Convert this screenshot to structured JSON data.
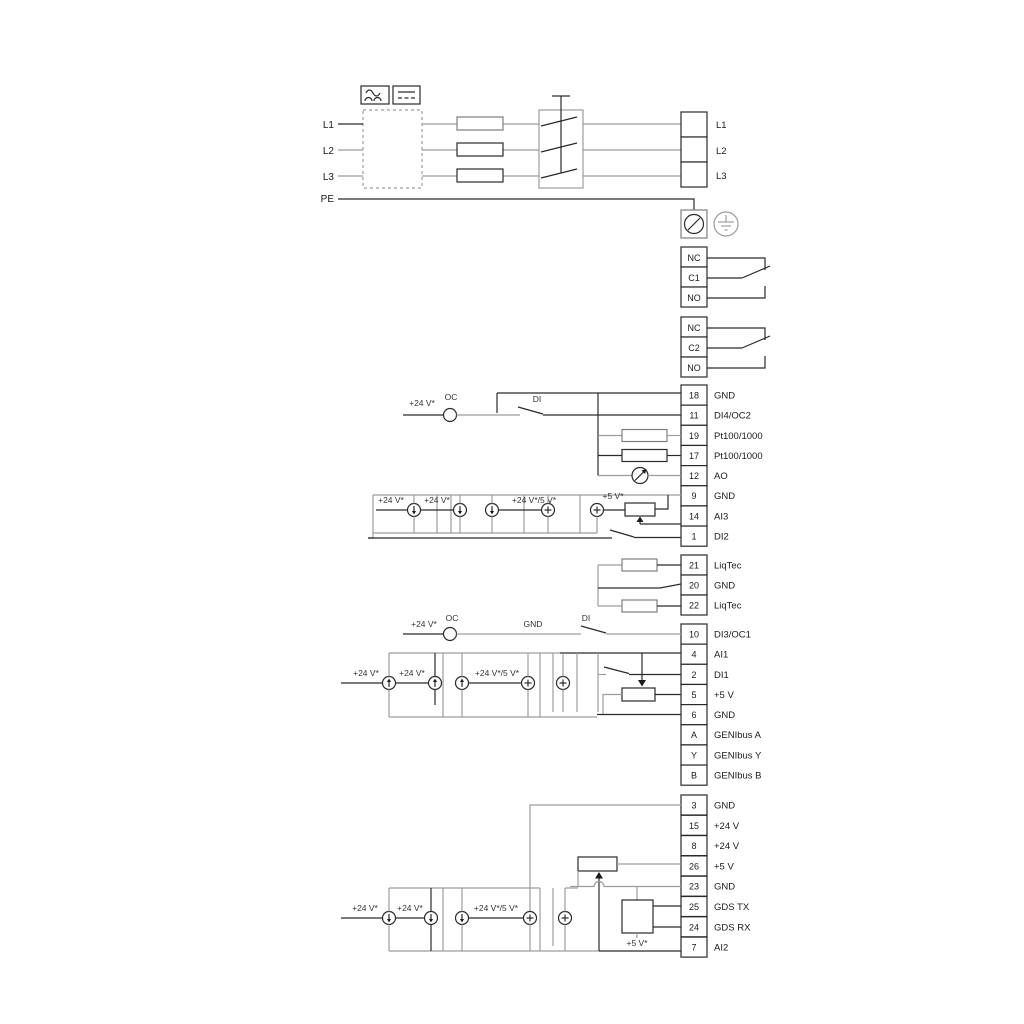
{
  "power": {
    "inputs": [
      "L1",
      "L2",
      "L3",
      "PE"
    ],
    "outputs": [
      "L1",
      "L2",
      "L3"
    ]
  },
  "relay1": {
    "t1": "NC",
    "t2": "C1",
    "t3": "NO"
  },
  "relay2": {
    "t1": "NC",
    "t2": "C2",
    "t3": "NO"
  },
  "io1": {
    "terminals": [
      {
        "n": "18",
        "l": "GND"
      },
      {
        "n": "11",
        "l": "DI4/OC2"
      },
      {
        "n": "19",
        "l": "Pt100/1000"
      },
      {
        "n": "17",
        "l": "Pt100/1000"
      },
      {
        "n": "12",
        "l": "AO"
      },
      {
        "n": "9",
        "l": "GND"
      },
      {
        "n": "14",
        "l": "AI3"
      },
      {
        "n": "1",
        "l": "DI2"
      }
    ]
  },
  "liqtec": {
    "terminals": [
      {
        "n": "21",
        "l": "LiqTec"
      },
      {
        "n": "20",
        "l": "GND"
      },
      {
        "n": "22",
        "l": "LiqTec"
      }
    ]
  },
  "io2": {
    "terminals": [
      {
        "n": "10",
        "l": "DI3/OC1"
      },
      {
        "n": "4",
        "l": "AI1"
      },
      {
        "n": "2",
        "l": "DI1"
      },
      {
        "n": "5",
        "l": "+5 V"
      },
      {
        "n": "6",
        "l": "GND"
      },
      {
        "n": "A",
        "l": "GENIbus A"
      },
      {
        "n": "Y",
        "l": "GENIbus Y"
      },
      {
        "n": "B",
        "l": "GENIbus B"
      }
    ]
  },
  "io3": {
    "terminals": [
      {
        "n": "3",
        "l": "GND"
      },
      {
        "n": "15",
        "l": "+24 V"
      },
      {
        "n": "8",
        "l": "+24 V"
      },
      {
        "n": "26",
        "l": "+5 V"
      },
      {
        "n": "23",
        "l": "GND"
      },
      {
        "n": "25",
        "l": "GDS TX"
      },
      {
        "n": "24",
        "l": "GDS RX"
      },
      {
        "n": "7",
        "l": "AI2"
      }
    ]
  },
  "labels": {
    "v24": "+24 V*",
    "v24_5": "+24 V*/5 V*",
    "v5": "+5 V*",
    "oc": "OC",
    "di": "DI",
    "gnd": "GND"
  },
  "colors": {
    "wire_black": "#2a2a2a",
    "wire_gray": "#9c9c9c",
    "text": "#333333"
  }
}
